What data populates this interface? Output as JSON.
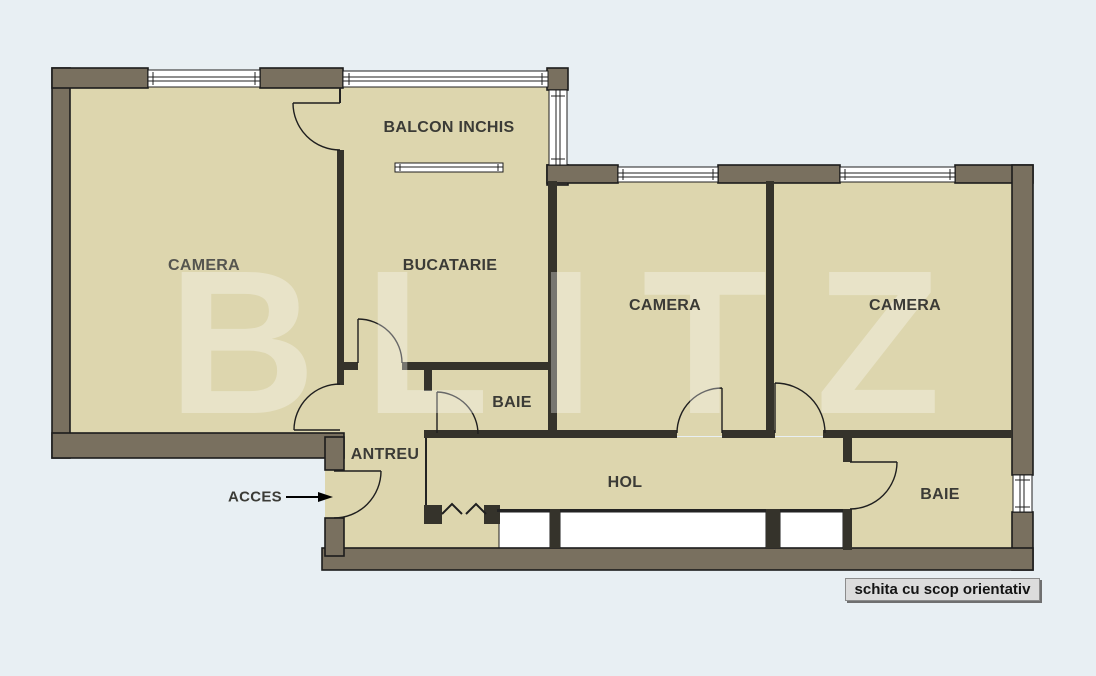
{
  "title": "apartment-floor-plan",
  "watermark": {
    "text": "BLITZ"
  },
  "rooms": {
    "balcony": "BALCON INCHIS",
    "camera_left": "CAMERA",
    "kitchen": "BUCATARIE",
    "camera_middle": "CAMERA",
    "camera_right": "CAMERA",
    "bathroom_center": "BAIE",
    "bathroom_right": "BAIE",
    "entry": "ANTREU",
    "hallway": "HOL"
  },
  "annotations": {
    "access_label": "ACCES",
    "disclaimer": "schita cu scop orientativ"
  },
  "colors": {
    "bg": "#e8eff3",
    "floor": "#ddd6ae",
    "wall": "#79705f",
    "wall_dark": "#35332b",
    "window": "#ffffff",
    "watermark": "rgba(255,255,255,0.33)",
    "label": "#3b3b36"
  }
}
